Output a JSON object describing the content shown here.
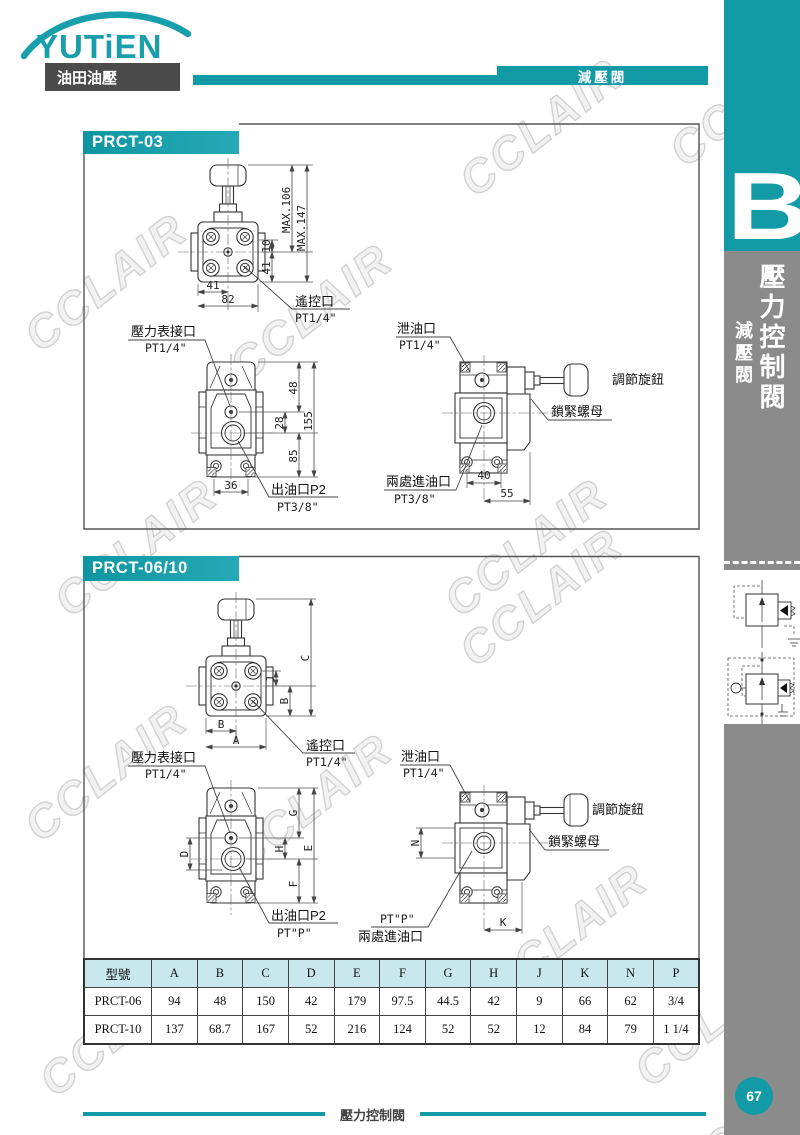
{
  "brand": {
    "logo_text": "YUTiEN",
    "logo_sub": "油田油壓",
    "header_tab": "減壓閥"
  },
  "sidebar": {
    "section_letter": "B",
    "title_vertical": "壓力控制閥",
    "subtitle_vertical": "減壓閥",
    "page_number": "67"
  },
  "watermark": {
    "text": "CCLAIR"
  },
  "s03": {
    "title": "PRCT-03",
    "top": {
      "max1": "MAX.106",
      "max2": "MAX.147",
      "d10": "10",
      "d41": "41",
      "b41": "41",
      "b82": "82",
      "remote": "遙控口",
      "remote_size": "PT1/4\""
    },
    "front": {
      "gauge": "壓力表接口",
      "gauge_size": "PT1/4\"",
      "d48": "48",
      "d28": "28",
      "d155": "155",
      "d85": "85",
      "d36": "36",
      "outlet": "出油口P2",
      "outlet_size": "PT3/8\""
    },
    "side": {
      "drain": "泄油口",
      "drain_size": "PT1/4\"",
      "knob": "調節旋鈕",
      "nut": "鎖緊螺母",
      "inlet": "兩處進油口",
      "inlet_size": "PT3/8\"",
      "d40": "40",
      "d55": "55"
    }
  },
  "s0610": {
    "title": "PRCT-06/10",
    "top": {
      "dC": "C",
      "dJ": "J",
      "dBv": "B",
      "dBh": "B",
      "dA": "A",
      "remote": "遙控口",
      "remote_size": "PT1/4\""
    },
    "front": {
      "gauge": "壓力表接口",
      "gauge_size": "PT1/4\"",
      "dD": "D",
      "dG": "G",
      "dH": "H",
      "dE": "E",
      "dF": "F",
      "outlet": "出油口P2",
      "outlet_size": "PT\"P\""
    },
    "side": {
      "drain": "泄油口",
      "drain_size": "PT1/4\"",
      "knob": "調節旋鈕",
      "nut": "鎖緊螺母",
      "inlet_p": "PT\"P\"",
      "inlet": "兩處進油口",
      "dN": "N",
      "dK": "K"
    }
  },
  "table": {
    "headers": [
      "型號",
      "A",
      "B",
      "C",
      "D",
      "E",
      "F",
      "G",
      "H",
      "J",
      "K",
      "N",
      "P"
    ],
    "rows": [
      [
        "PRCT-06",
        "94",
        "48",
        "150",
        "42",
        "179",
        "97.5",
        "44.5",
        "42",
        "9",
        "66",
        "62",
        "3/4"
      ],
      [
        "PRCT-10",
        "137",
        "68.7",
        "167",
        "52",
        "216",
        "124",
        "52",
        "52",
        "12",
        "84",
        "79",
        "1 1/4"
      ]
    ]
  },
  "footer": {
    "label": "壓力控制閥"
  },
  "colors": {
    "teal": "#129BA6",
    "sidebar_gray": "#8B8B8B",
    "logo_box_gray": "#4B4B4B",
    "table_header_bg": "#C9E8EE",
    "line_dark": "#333333"
  }
}
